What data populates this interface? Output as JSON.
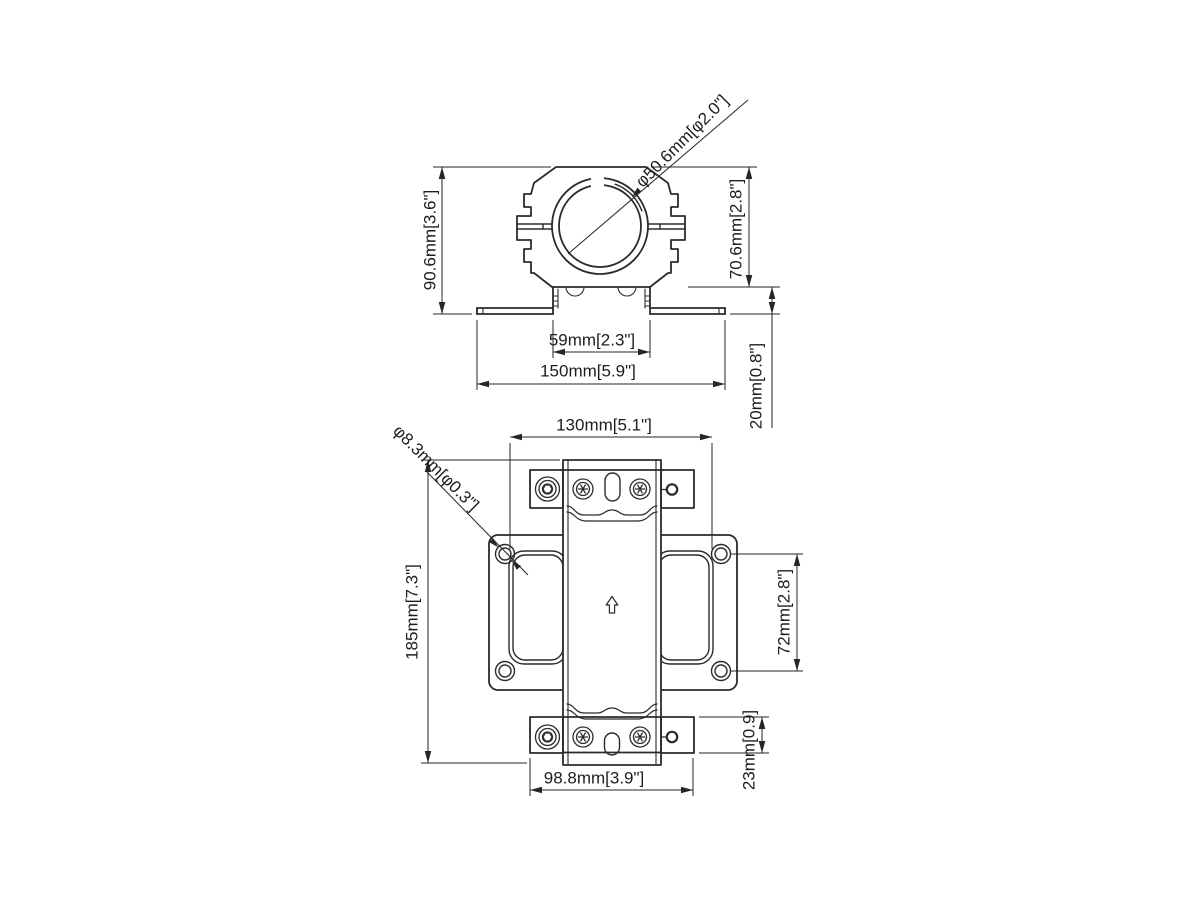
{
  "colors": {
    "line": "#2b2b2b",
    "dimension": "#262626",
    "text": "#1d1d1d",
    "background": "#ffffff"
  },
  "top_view": {
    "overall_height": "90.6mm[3.6\"]",
    "clamp_diameter": "φ50.6mm[φ2.0\"]",
    "clamp_height": "70.6mm[2.8\"]",
    "channel_width": "59mm[2.3\"]",
    "flange_width": "150mm[5.9\"]",
    "base_height": "20mm[0.8\"]"
  },
  "front_view": {
    "cutout_span": "130mm[5.1\"]",
    "hole_diameter": "φ8.3mm[φ0.3\"]",
    "overall_height": "185mm[7.3\"]",
    "hole_spacing": "72mm[2.8\"]",
    "block_width": "98.8mm[3.9\"]",
    "block_height": "23mm[0.9]"
  }
}
